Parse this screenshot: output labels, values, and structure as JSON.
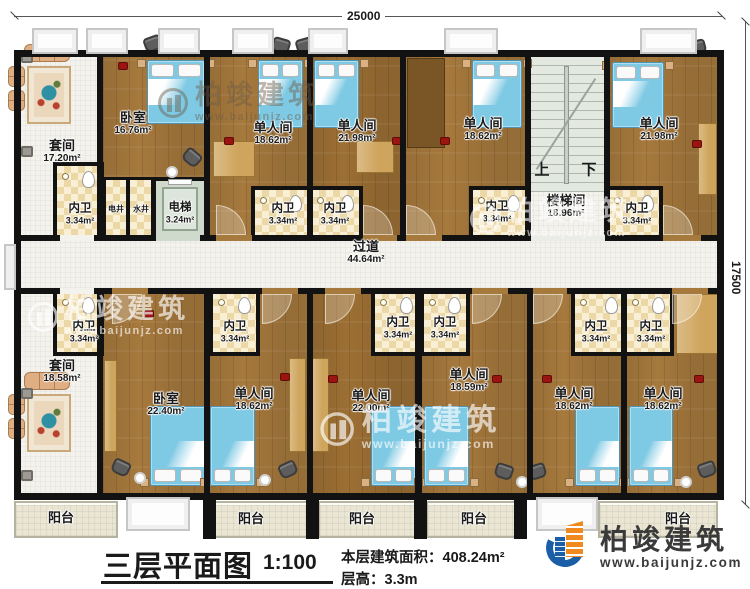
{
  "dimensions": {
    "top": "25000",
    "right": "17500"
  },
  "corridor": {
    "name": "过道",
    "area": "44.64m²"
  },
  "stairwell": {
    "name": "楼梯间",
    "area": "18.96m²",
    "up": "上",
    "down": "下"
  },
  "elevator": {
    "name": "电梯",
    "area": "3.24m²"
  },
  "shafts": {
    "electric": "电井",
    "water": "水井"
  },
  "bathroom": {
    "name": "内卫",
    "area": "3.34m²"
  },
  "balcony": {
    "label": "阳台"
  },
  "rooms": {
    "top": [
      {
        "name": "套间",
        "area": "17.20m²"
      },
      {
        "name": "卧室",
        "area": "16.76m²"
      },
      {
        "name": "单人间",
        "area": "18.62m²"
      },
      {
        "name": "单人间",
        "area": "21.98m²"
      },
      {
        "name": "单人间",
        "area": "18.62m²"
      },
      {
        "name": "单人间",
        "area": "21.98m²"
      }
    ],
    "bottom": [
      {
        "name": "套间",
        "area": "18.58m²"
      },
      {
        "name": "卧室",
        "area": "22.40m²"
      },
      {
        "name": "单人间",
        "area": "18.62m²"
      },
      {
        "name": "单人间",
        "area": "22.00m²"
      },
      {
        "name": "单人间",
        "area": "18.59m²"
      },
      {
        "name": "单人间",
        "area": "18.62m²"
      },
      {
        "name": "单人间",
        "area": "18.62m²"
      }
    ]
  },
  "footer": {
    "title": "三层平面图",
    "scale": "1:100",
    "floor_area_label": "本层建筑面积：",
    "floor_area_value": "408.24m²",
    "floor_height_label": "层高：",
    "floor_height_value": "3.3m"
  },
  "brand": {
    "name": "柏竣建筑",
    "url": "www.baijunjz.com"
  },
  "watermark": {
    "name": "柏竣建筑",
    "url": "www.baijunjz.com"
  }
}
